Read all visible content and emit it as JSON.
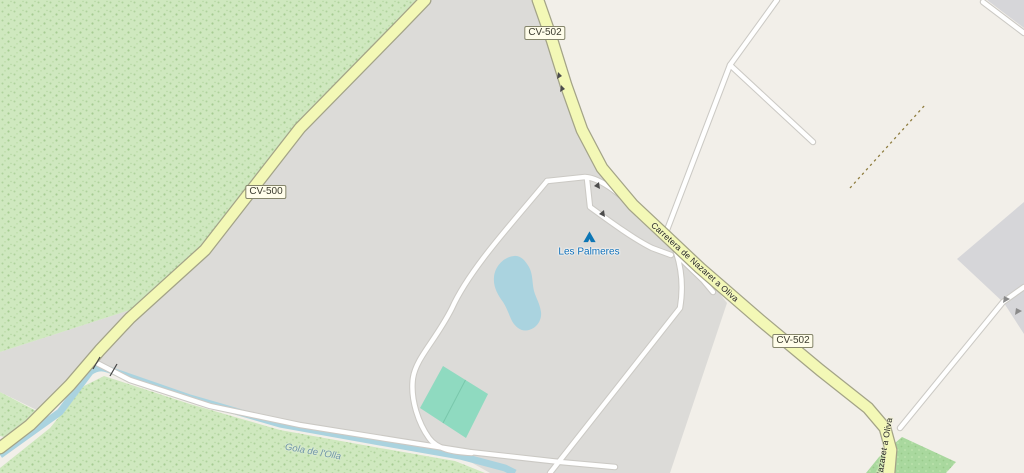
{
  "labels": {
    "shield_cv502_north": "CV-502",
    "shield_cv500": "CV-500",
    "shield_cv502_south": "CV-502",
    "road_name": "Carretera de Nazaret a Oliva",
    "road_name_short": "Nazaret a Oliva",
    "campsite": "Les Palmeres",
    "waterway": "Gola de l'Olla"
  },
  "icons": {
    "campsite": "tent-icon"
  },
  "colors": {
    "background": "#f2efe9",
    "residential_gray": "#dcdbd8",
    "gray_area_right": "#d6d6d9",
    "forest_green": "#cfe8bf",
    "orchard_green": "#a9d89e",
    "water_blue": "#aad3df",
    "pitch_green": "#8fdac0",
    "road_secondary_fill": "#f3f8b6",
    "road_secondary_casing": "#a3a387",
    "road_minor_fill": "#ffffff",
    "road_minor_casing": "#cbc9c4",
    "track_dashed": "#8f7d3f",
    "poi_blue": "#0d6fb8",
    "water_label": "#6e95a8"
  }
}
